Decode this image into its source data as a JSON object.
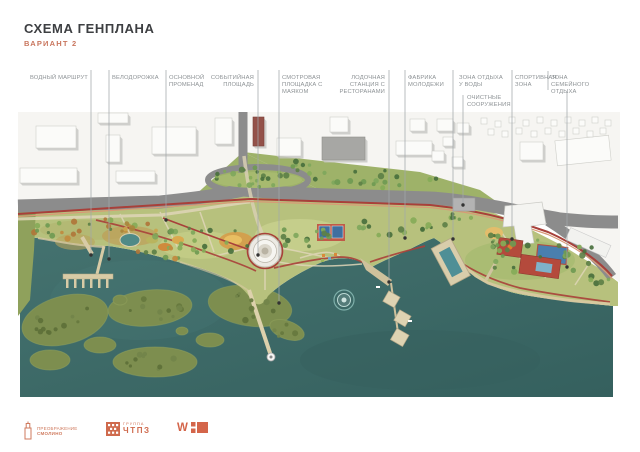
{
  "header": {
    "title": "СХЕМА ГЕНПЛАНА",
    "subtitle": "ВАРИАНТ 2"
  },
  "labels": [
    {
      "id": "vodny-marshrut",
      "lines": [
        "ВОДНЫЙ МАРШРУТ"
      ]
    },
    {
      "id": "velodorozhka",
      "lines": [
        "ВЕЛОДОРОЖКА"
      ]
    },
    {
      "id": "osnovnoy-promenad",
      "lines": [
        "ОСНОВНОЙ",
        "ПРОМЕНАД"
      ]
    },
    {
      "id": "sobytiynaya-ploshchad",
      "lines": [
        "СОБЫТИЙНАЯ",
        "ПЛОЩАДЬ"
      ]
    },
    {
      "id": "smotrovaya-ploshchadka",
      "lines": [
        "СМОТРОВАЯ",
        "ПЛОЩАДКА С",
        "МАЯКОМ"
      ]
    },
    {
      "id": "lodochnaya-stantsiya",
      "lines": [
        "ЛОДОЧНАЯ",
        "СТАНЦИЯ С",
        "РЕСТОРАНАМИ"
      ]
    },
    {
      "id": "fabrika-molodezhi",
      "lines": [
        "ФАБРИКА",
        "МОЛОДЕЖИ"
      ]
    },
    {
      "id": "zona-otdykha-u-vody",
      "lines": [
        "ЗОНА ОТДЫХА",
        "У ВОДЫ"
      ]
    },
    {
      "id": "ochistnye-sooruzheniya",
      "lines": [
        "ОЧИСТНЫЕ",
        "СООРУЖЕНИЯ"
      ]
    },
    {
      "id": "sportivnaya-zona",
      "lines": [
        "СПОРТИВНАЯ",
        "ЗОНА"
      ]
    },
    {
      "id": "zona-semeynogo-otdykha",
      "lines": [
        "ЗОНА СЕМЕЙНОГО",
        "ОТДЫХА"
      ]
    }
  ],
  "footer": {
    "logos": [
      {
        "name": "preobrazhenie-smolino",
        "line1": "ПРЕОБРАЖЕНИЕ",
        "line2": "СМОЛИНО"
      },
      {
        "name": "gruppa-chtpz",
        "line1": "ГРУППА",
        "line2": "ЧТПЗ"
      },
      {
        "name": "w-logo",
        "letter": "W"
      }
    ]
  },
  "map": {
    "colors": {
      "water": "#3f6e6c",
      "water_deep": "#35605e",
      "land": "#b7c17d",
      "road": "#8c8c8c",
      "route_red": "#a8403a",
      "route_light": "#d89a76",
      "marsh": "#7d8e4f",
      "pier": "#d8cba6",
      "city": "#f6f5f2",
      "accent_orange": "#cf7a5e",
      "leader": "#a2a7aa",
      "dot": "#333333"
    }
  }
}
